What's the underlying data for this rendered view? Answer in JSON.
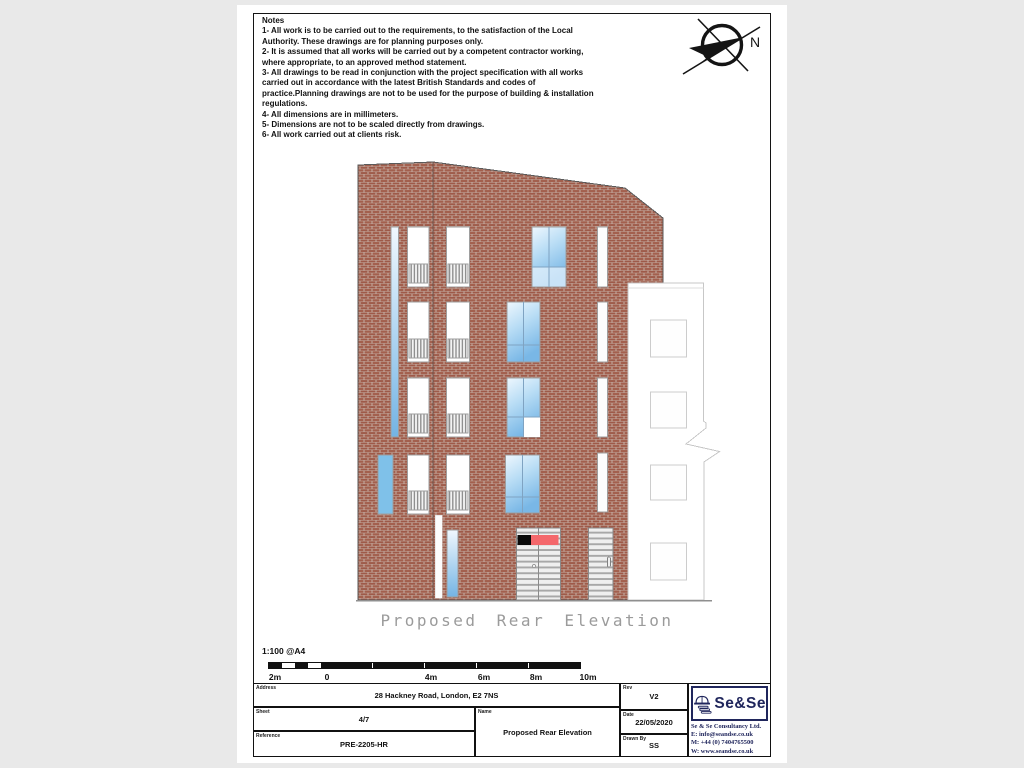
{
  "notes": {
    "title": "Notes",
    "items": [
      "1- All work is to be carried out to the requirements, to the satisfaction of the Local Authority. These drawings are for planning purposes only.",
      "2- It is assumed that all works will be carried out by a competent contractor working, where appropriate, to an approved method statement.",
      "3- All drawings to be read in conjunction with the project specification with all works carried out in accordance with the latest British Standards and codes of practice.Planning drawings are not to be used for the purpose of building & installation regulations.",
      "4- All dimensions are in millimeters.",
      "5- Dimensions are not to be scaled directly from drawings.",
      "6- All work carried out at clients risk."
    ]
  },
  "compass": {
    "north_label": "N"
  },
  "drawing": {
    "caption": "Proposed Rear Elevation"
  },
  "scale_bar": {
    "scale_label": "1:100 @A4",
    "tick_labels": [
      "2m",
      "0",
      "4m",
      "6m",
      "8m",
      "10m"
    ]
  },
  "title_block": {
    "address_label": "Address",
    "address": "28 Hackney Road, London, E2 7NS",
    "sheet_label": "Sheet",
    "sheet": "4/7",
    "reference_label": "Reference",
    "reference": "PRE-2205-HR",
    "name_label": "Name",
    "name": "Proposed Rear Elevation",
    "rev_label": "Rev",
    "rev": "V2",
    "date_label": "Date",
    "date": "22/05/2020",
    "drawn_by_label": "Drawn By",
    "drawn_by": "SS",
    "logo_text": "Se&Se",
    "company": {
      "name": "Se & Se Consultancy Ltd.",
      "email": "E: info@seandse.co.uk",
      "mobile": "M: +44 (0) 7404765500",
      "web": "W: www.seandse.co.uk"
    }
  },
  "colors": {
    "brick": "#9e5a49",
    "mortar": "#c6b0a6",
    "glass_blue": "#7db9e7",
    "sign_red": "#f4686c",
    "sign_black": "#0a0a0a",
    "navy": "#20265c",
    "caption_gray": "#9b9b9b"
  }
}
